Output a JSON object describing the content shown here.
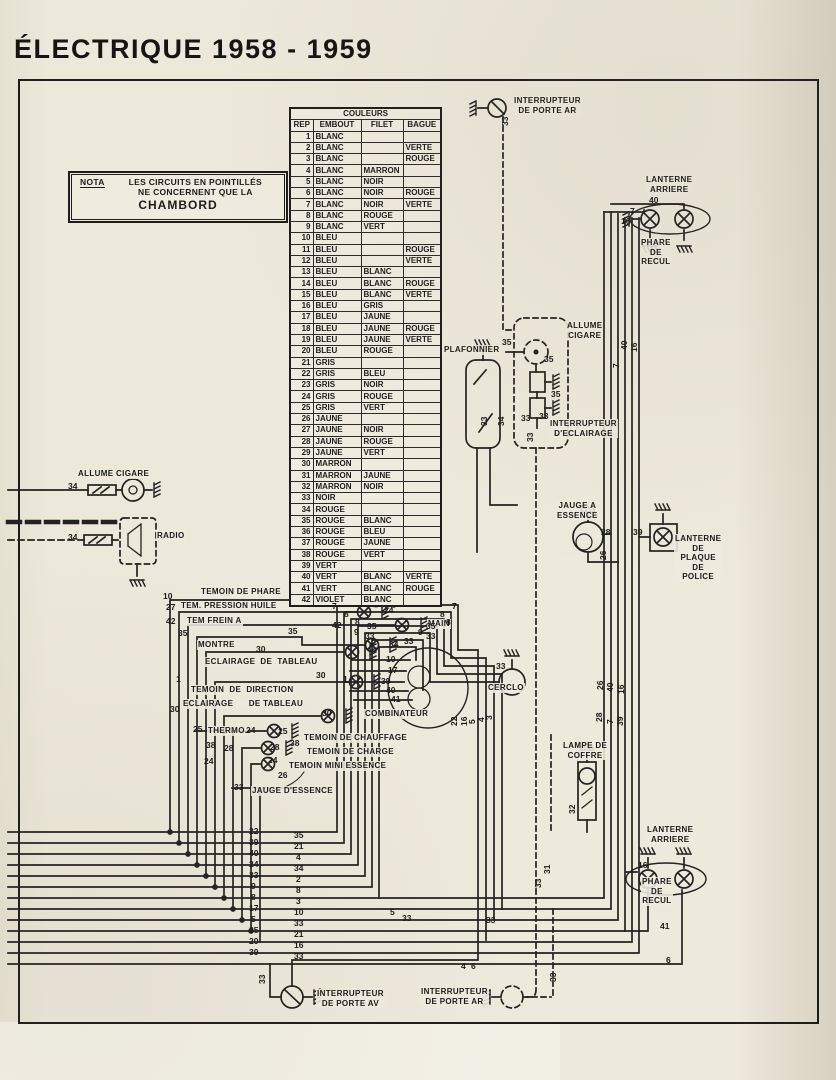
{
  "title": "ÉLECTRIQUE  1958 - 1959",
  "nota": {
    "tag": "NOTA",
    "line1": "LES CIRCUITS EN POINTILLÉS",
    "line2": "NE CONCERNENT QUE LA",
    "line3": "CHAMBORD"
  },
  "colors_table": {
    "title": "COULEURS",
    "headers": [
      "REP",
      "EMBOUT",
      "FILET",
      "BAGUE"
    ],
    "rows": [
      [
        "1",
        "BLANC",
        "",
        ""
      ],
      [
        "2",
        "BLANC",
        "",
        "VERTE"
      ],
      [
        "3",
        "BLANC",
        "",
        "ROUGE"
      ],
      [
        "4",
        "BLANC",
        "MARRON",
        ""
      ],
      [
        "5",
        "BLANC",
        "NOIR",
        ""
      ],
      [
        "6",
        "BLANC",
        "NOIR",
        "ROUGE"
      ],
      [
        "7",
        "BLANC",
        "NOIR",
        "VERTE"
      ],
      [
        "8",
        "BLANC",
        "ROUGE",
        ""
      ],
      [
        "9",
        "BLANC",
        "VERT",
        ""
      ],
      [
        "10",
        "BLEU",
        "",
        ""
      ],
      [
        "11",
        "BLEU",
        "",
        "ROUGE"
      ],
      [
        "12",
        "BLEU",
        "",
        "VERTE"
      ],
      [
        "13",
        "BLEU",
        "BLANC",
        ""
      ],
      [
        "14",
        "BLEU",
        "BLANC",
        "ROUGE"
      ],
      [
        "15",
        "BLEU",
        "BLANC",
        "VERTE"
      ],
      [
        "16",
        "BLEU",
        "GRIS",
        ""
      ],
      [
        "17",
        "BLEU",
        "JAUNE",
        ""
      ],
      [
        "18",
        "BLEU",
        "JAUNE",
        "ROUGE"
      ],
      [
        "19",
        "BLEU",
        "JAUNE",
        "VERTE"
      ],
      [
        "20",
        "BLEU",
        "ROUGE",
        ""
      ],
      [
        "21",
        "GRIS",
        "",
        ""
      ],
      [
        "22",
        "GRIS",
        "BLEU",
        ""
      ],
      [
        "23",
        "GRIS",
        "NOIR",
        ""
      ],
      [
        "24",
        "GRIS",
        "ROUGE",
        ""
      ],
      [
        "25",
        "GRIS",
        "VERT",
        ""
      ],
      [
        "26",
        "JAUNE",
        "",
        ""
      ],
      [
        "27",
        "JAUNE",
        "NOIR",
        ""
      ],
      [
        "28",
        "JAUNE",
        "ROUGE",
        ""
      ],
      [
        "29",
        "JAUNE",
        "VERT",
        ""
      ],
      [
        "30",
        "MARRON",
        "",
        ""
      ],
      [
        "31",
        "MARRON",
        "JAUNE",
        ""
      ],
      [
        "32",
        "MARRON",
        "NOIR",
        ""
      ],
      [
        "33",
        "NOIR",
        "",
        ""
      ],
      [
        "34",
        "ROUGE",
        "",
        ""
      ],
      [
        "35",
        "ROUGE",
        "BLANC",
        ""
      ],
      [
        "36",
        "ROUGE",
        "BLEU",
        ""
      ],
      [
        "37",
        "ROUGE",
        "JAUNE",
        ""
      ],
      [
        "38",
        "ROUGE",
        "VERT",
        ""
      ],
      [
        "39",
        "VERT",
        "",
        ""
      ],
      [
        "40",
        "VERT",
        "BLANC",
        "VERTE"
      ],
      [
        "41",
        "VERT",
        "BLANC",
        "ROUGE"
      ],
      [
        "42",
        "VIOLET",
        "BLANC",
        ""
      ]
    ]
  },
  "labels": [
    {
      "name": "interrupteur-porte-ar-top",
      "text": "INTERRUPTEUR\nDE PORTE AR",
      "x": 513,
      "y": 96
    },
    {
      "name": "lanterne-arriere-top",
      "text": "LANTERNE\nARRIERE",
      "x": 645,
      "y": 175
    },
    {
      "name": "phare-de-recul-top",
      "text": "PHARE\nDE\nRECUL",
      "x": 640,
      "y": 238
    },
    {
      "name": "plafonnier",
      "text": "PLAFONNIER",
      "x": 443,
      "y": 345
    },
    {
      "name": "allume-cigare-right",
      "text": "ALLUME\nCIGARE",
      "x": 566,
      "y": 321
    },
    {
      "name": "interrupteur-eclairage",
      "text": "INTERRUPTEUR\nD'ECLAIRAGE",
      "x": 549,
      "y": 419
    },
    {
      "name": "jauge-a-essence",
      "text": "JAUGE A\nESSENCE",
      "x": 556,
      "y": 501
    },
    {
      "name": "lanterne-plaque-police",
      "text": "LANTERNE\nDE\nPLAQUE\nDE\nPOLICE",
      "x": 674,
      "y": 534
    },
    {
      "name": "allume-cigare-left",
      "text": "ALLUME CIGARE",
      "x": 77,
      "y": 469
    },
    {
      "name": "radio",
      "text": "RADIO",
      "x": 156,
      "y": 531
    },
    {
      "name": "temoin-de-phare",
      "text": "TEMOIN DE PHARE",
      "x": 200,
      "y": 587
    },
    {
      "name": "tem-pression-huile",
      "text": "TEM. PRESSION HUILE",
      "x": 180,
      "y": 601
    },
    {
      "name": "tem-frein-a",
      "text": "TEM FREIN A",
      "x": 186,
      "y": 616
    },
    {
      "name": "frein-main",
      "text": "MAIN",
      "x": 427,
      "y": 619
    },
    {
      "name": "montre",
      "text": "MONTRE",
      "x": 197,
      "y": 640
    },
    {
      "name": "eclairage-de-tableau-1",
      "text": "ECLAIRAGE  DE  TABLEAU",
      "x": 204,
      "y": 657
    },
    {
      "name": "temoin-de-direction",
      "text": "TEMOIN  DE  DIRECTION",
      "x": 190,
      "y": 685
    },
    {
      "name": "eclairage-de-tableau-2",
      "text": "ECLAIRAGE      DE TABLEAU",
      "x": 182,
      "y": 699
    },
    {
      "name": "thermo",
      "text": "THERMO.",
      "x": 207,
      "y": 726
    },
    {
      "name": "temoin-de-chauffage",
      "text": "TEMOIN DE CHAUFFAGE",
      "x": 303,
      "y": 733
    },
    {
      "name": "temoin-de-charge",
      "text": "TEMOIN DE CHARGE",
      "x": 306,
      "y": 747
    },
    {
      "name": "temoin-mini-essence",
      "text": "TEMOIN MINI ESSENCE",
      "x": 288,
      "y": 761
    },
    {
      "name": "jauge-d-essence",
      "text": "JAUGE D'ESSENCE",
      "x": 251,
      "y": 786
    },
    {
      "name": "combinateur",
      "text": "COMBINATEUR",
      "x": 364,
      "y": 709
    },
    {
      "name": "cerclo",
      "text": "CERCLO",
      "x": 487,
      "y": 683
    },
    {
      "name": "lampe-de-coffre",
      "text": "LAMPE DE\nCOFFRE",
      "x": 562,
      "y": 741
    },
    {
      "name": "lanterne-arriere-bottom",
      "text": "LANTERNE\nARRIERE",
      "x": 646,
      "y": 825
    },
    {
      "name": "phare-de-recul-bottom",
      "text": "PHARE\nDE\nRECUL",
      "x": 641,
      "y": 877
    },
    {
      "name": "interrupteur-porte-av",
      "text": "INTERRUPTEUR\nDE PORTE AV",
      "x": 316,
      "y": 989
    },
    {
      "name": "interrupteur-porte-ar-bottom",
      "text": "INTERRUPTEUR\nDE PORTE AR",
      "x": 420,
      "y": 987
    }
  ],
  "wire_numbers": [
    {
      "t": "33",
      "x": 501,
      "y": 126,
      "v": 1
    },
    {
      "t": "40",
      "x": 649,
      "y": 196
    },
    {
      "t": "7",
      "x": 630,
      "y": 207
    },
    {
      "t": "16",
      "x": 621,
      "y": 217
    },
    {
      "t": "40",
      "x": 620,
      "y": 350,
      "v": 1
    },
    {
      "t": "16",
      "x": 630,
      "y": 352,
      "v": 1
    },
    {
      "t": "7",
      "x": 612,
      "y": 368,
      "v": 1
    },
    {
      "t": "35",
      "x": 502,
      "y": 338
    },
    {
      "t": "35",
      "x": 544,
      "y": 355
    },
    {
      "t": "35",
      "x": 551,
      "y": 390
    },
    {
      "t": "33",
      "x": 480,
      "y": 426,
      "v": 1
    },
    {
      "t": "34",
      "x": 497,
      "y": 426,
      "v": 1
    },
    {
      "t": "33",
      "x": 521,
      "y": 414
    },
    {
      "t": "33",
      "x": 539,
      "y": 412
    },
    {
      "t": "33",
      "x": 526,
      "y": 442,
      "v": 1
    },
    {
      "t": "28",
      "x": 601,
      "y": 528
    },
    {
      "t": "26",
      "x": 599,
      "y": 560,
      "v": 1
    },
    {
      "t": "39",
      "x": 633,
      "y": 528
    },
    {
      "t": "34",
      "x": 68,
      "y": 482
    },
    {
      "t": "34",
      "x": 68,
      "y": 533
    },
    {
      "t": "10",
      "x": 163,
      "y": 592
    },
    {
      "t": "24",
      "x": 384,
      "y": 606
    },
    {
      "t": "27",
      "x": 166,
      "y": 603
    },
    {
      "t": "42",
      "x": 166,
      "y": 617
    },
    {
      "t": "42",
      "x": 332,
      "y": 621
    },
    {
      "t": "35",
      "x": 178,
      "y": 629
    },
    {
      "t": "35",
      "x": 288,
      "y": 627
    },
    {
      "t": "30",
      "x": 256,
      "y": 645
    },
    {
      "t": "30",
      "x": 316,
      "y": 671
    },
    {
      "t": "1",
      "x": 176,
      "y": 675
    },
    {
      "t": "1",
      "x": 343,
      "y": 675
    },
    {
      "t": "30",
      "x": 170,
      "y": 705
    },
    {
      "t": "30",
      "x": 322,
      "y": 709
    },
    {
      "t": "25",
      "x": 193,
      "y": 725
    },
    {
      "t": "24",
      "x": 246,
      "y": 726
    },
    {
      "t": "25",
      "x": 278,
      "y": 727
    },
    {
      "t": "38",
      "x": 206,
      "y": 741
    },
    {
      "t": "28",
      "x": 224,
      "y": 744
    },
    {
      "t": "28",
      "x": 270,
      "y": 743
    },
    {
      "t": "38",
      "x": 290,
      "y": 739
    },
    {
      "t": "24",
      "x": 204,
      "y": 757
    },
    {
      "t": "24",
      "x": 268,
      "y": 756
    },
    {
      "t": "26",
      "x": 278,
      "y": 771
    },
    {
      "t": "33",
      "x": 234,
      "y": 783
    },
    {
      "t": "7",
      "x": 332,
      "y": 602
    },
    {
      "t": "8",
      "x": 344,
      "y": 610
    },
    {
      "t": "8",
      "x": 355,
      "y": 618
    },
    {
      "t": "35",
      "x": 367,
      "y": 622
    },
    {
      "t": "9",
      "x": 354,
      "y": 628
    },
    {
      "t": "33",
      "x": 365,
      "y": 632
    },
    {
      "t": "34",
      "x": 389,
      "y": 640
    },
    {
      "t": "7",
      "x": 452,
      "y": 602
    },
    {
      "t": "8",
      "x": 440,
      "y": 610
    },
    {
      "t": "8",
      "x": 446,
      "y": 618
    },
    {
      "t": "35",
      "x": 426,
      "y": 622
    },
    {
      "t": "9",
      "x": 418,
      "y": 628
    },
    {
      "t": "33",
      "x": 426,
      "y": 632
    },
    {
      "t": "10",
      "x": 386,
      "y": 655
    },
    {
      "t": "17",
      "x": 388,
      "y": 666
    },
    {
      "t": "39",
      "x": 381,
      "y": 677
    },
    {
      "t": "40",
      "x": 386,
      "y": 686
    },
    {
      "t": "41",
      "x": 391,
      "y": 695
    },
    {
      "t": "33",
      "x": 404,
      "y": 637
    },
    {
      "t": "33",
      "x": 496,
      "y": 662
    },
    {
      "t": "22",
      "x": 450,
      "y": 726,
      "v": 1
    },
    {
      "t": "16",
      "x": 460,
      "y": 726,
      "v": 1
    },
    {
      "t": "5",
      "x": 468,
      "y": 724,
      "v": 1
    },
    {
      "t": "4",
      "x": 477,
      "y": 722,
      "v": 1
    },
    {
      "t": "3",
      "x": 485,
      "y": 720,
      "v": 1
    },
    {
      "t": "26",
      "x": 596,
      "y": 690,
      "v": 1
    },
    {
      "t": "40",
      "x": 606,
      "y": 692,
      "v": 1
    },
    {
      "t": "16",
      "x": 617,
      "y": 694,
      "v": 1
    },
    {
      "t": "28",
      "x": 595,
      "y": 722,
      "v": 1
    },
    {
      "t": "7",
      "x": 606,
      "y": 724,
      "v": 1
    },
    {
      "t": "39",
      "x": 616,
      "y": 726,
      "v": 1
    },
    {
      "t": "32",
      "x": 568,
      "y": 814,
      "v": 1
    },
    {
      "t": "16",
      "x": 638,
      "y": 861
    },
    {
      "t": "41",
      "x": 660,
      "y": 922
    },
    {
      "t": "6",
      "x": 666,
      "y": 956
    },
    {
      "t": "5",
      "x": 390,
      "y": 908
    },
    {
      "t": "33",
      "x": 402,
      "y": 914
    },
    {
      "t": "33",
      "x": 486,
      "y": 916
    },
    {
      "t": "33",
      "x": 534,
      "y": 888,
      "v": 1
    },
    {
      "t": "31",
      "x": 543,
      "y": 874,
      "v": 1
    },
    {
      "t": "33",
      "x": 258,
      "y": 984,
      "v": 1
    },
    {
      "t": "33",
      "x": 549,
      "y": 982,
      "v": 1
    },
    {
      "t": "4",
      "x": 461,
      "y": 962
    },
    {
      "t": "6",
      "x": 471,
      "y": 962
    },
    {
      "t": "22",
      "x": 249,
      "y": 827
    },
    {
      "t": "35",
      "x": 294,
      "y": 831
    },
    {
      "t": "39",
      "x": 249,
      "y": 838
    },
    {
      "t": "21",
      "x": 294,
      "y": 842
    },
    {
      "t": "40",
      "x": 249,
      "y": 849
    },
    {
      "t": "4",
      "x": 296,
      "y": 853
    },
    {
      "t": "24",
      "x": 249,
      "y": 860
    },
    {
      "t": "34",
      "x": 294,
      "y": 864
    },
    {
      "t": "33",
      "x": 249,
      "y": 871
    },
    {
      "t": "2",
      "x": 296,
      "y": 875
    },
    {
      "t": "9",
      "x": 251,
      "y": 882
    },
    {
      "t": "8",
      "x": 296,
      "y": 886
    },
    {
      "t": "8",
      "x": 251,
      "y": 893
    },
    {
      "t": "3",
      "x": 296,
      "y": 897
    },
    {
      "t": "17",
      "x": 249,
      "y": 904
    },
    {
      "t": "10",
      "x": 294,
      "y": 908
    },
    {
      "t": "5",
      "x": 251,
      "y": 915
    },
    {
      "t": "33",
      "x": 294,
      "y": 919
    },
    {
      "t": "35",
      "x": 249,
      "y": 926
    },
    {
      "t": "21",
      "x": 294,
      "y": 930
    },
    {
      "t": "20",
      "x": 249,
      "y": 937
    },
    {
      "t": "16",
      "x": 294,
      "y": 941
    },
    {
      "t": "39",
      "x": 249,
      "y": 948
    },
    {
      "t": "33",
      "x": 294,
      "y": 952
    }
  ],
  "palette": {
    "paper": "#ece8da",
    "ink": "#1d1d1d"
  }
}
